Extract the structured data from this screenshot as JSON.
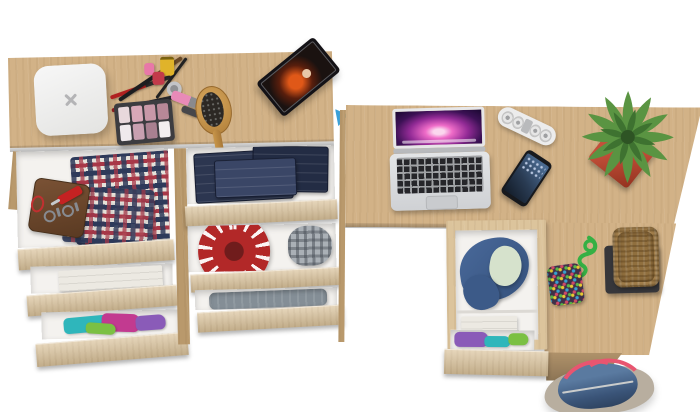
{
  "scene": {
    "background": "#ffffff",
    "type": "top-down 3d furniture render"
  },
  "palette": {
    "wood": "#d2b287",
    "wood_light": "#dcc49c",
    "wood_dark": "#b9996c",
    "drawer_interior": "#f4f2ef",
    "laptop_silver": "#d9dbdd",
    "screen_aurora_pink": "#b0348e",
    "power_strip_white": "#ececec",
    "phone_black": "#17191d",
    "plant_green": "#5a9442",
    "plant_green_dark": "#3e7230",
    "pot_red": "#b5432f",
    "basket_wicker": "#a9844e",
    "basket_tray": "#36363a",
    "purse_base": "#403048",
    "rope_green": "#35b044",
    "bag_denim": "#4a6890",
    "bag_strap_pink": "#e85570",
    "bag_canvas": "#b8ae9f",
    "hat_red": "#b22828",
    "cap_gray": "#aab0b6",
    "jeans_denim": "#2c3650",
    "jacket_blue": "#49699a",
    "jacket_lining": "#d6e2cc",
    "towel_white": "#ece9e2",
    "sweater_gray": "#848e96",
    "plaid_red": "#a83848",
    "plaid_navy": "#2e3a5a",
    "wallet_brown": "#6a462c",
    "knife_red": "#c42222",
    "scale_white": "#f2f2f2",
    "eyeshadow_case": "#3c3c40",
    "hairbrush_wood": "#c8964a",
    "tee_teal": "#2fb6bb",
    "tee_magenta": "#c23a90",
    "tee_green": "#7bc043",
    "tee_purple": "#8a5bb8",
    "tablet_black": "#141216",
    "tablet_stand_blue": "#3aa0d8"
  },
  "items": {
    "dresser_top": [
      "bathroom-scale",
      "makeup-brushes",
      "nail-polish-bottles",
      "lipstick",
      "lip-gloss",
      "eyeshadow-palette",
      "hairbrush",
      "tablet-with-movie"
    ],
    "dresser_drawers": [
      "plaid-shirts",
      "leather-wallet",
      "keys",
      "pocket-knife",
      "folded-jeans",
      "red-hat",
      "gray-plaid-cap",
      "white-towels",
      "folded-tshirts",
      "gray-sweater"
    ],
    "desk_top": [
      "macbook-laptop",
      "power-strip",
      "smartphone",
      "potted-plant"
    ],
    "desk_side": [
      "wicker-basket",
      "polka-dot-purse",
      "green-rope-keychain"
    ],
    "desk_drawer": [
      "blue-jacket",
      "white-towels",
      "folded-tshirts"
    ],
    "floor": [
      "denim-travel-bag"
    ]
  }
}
